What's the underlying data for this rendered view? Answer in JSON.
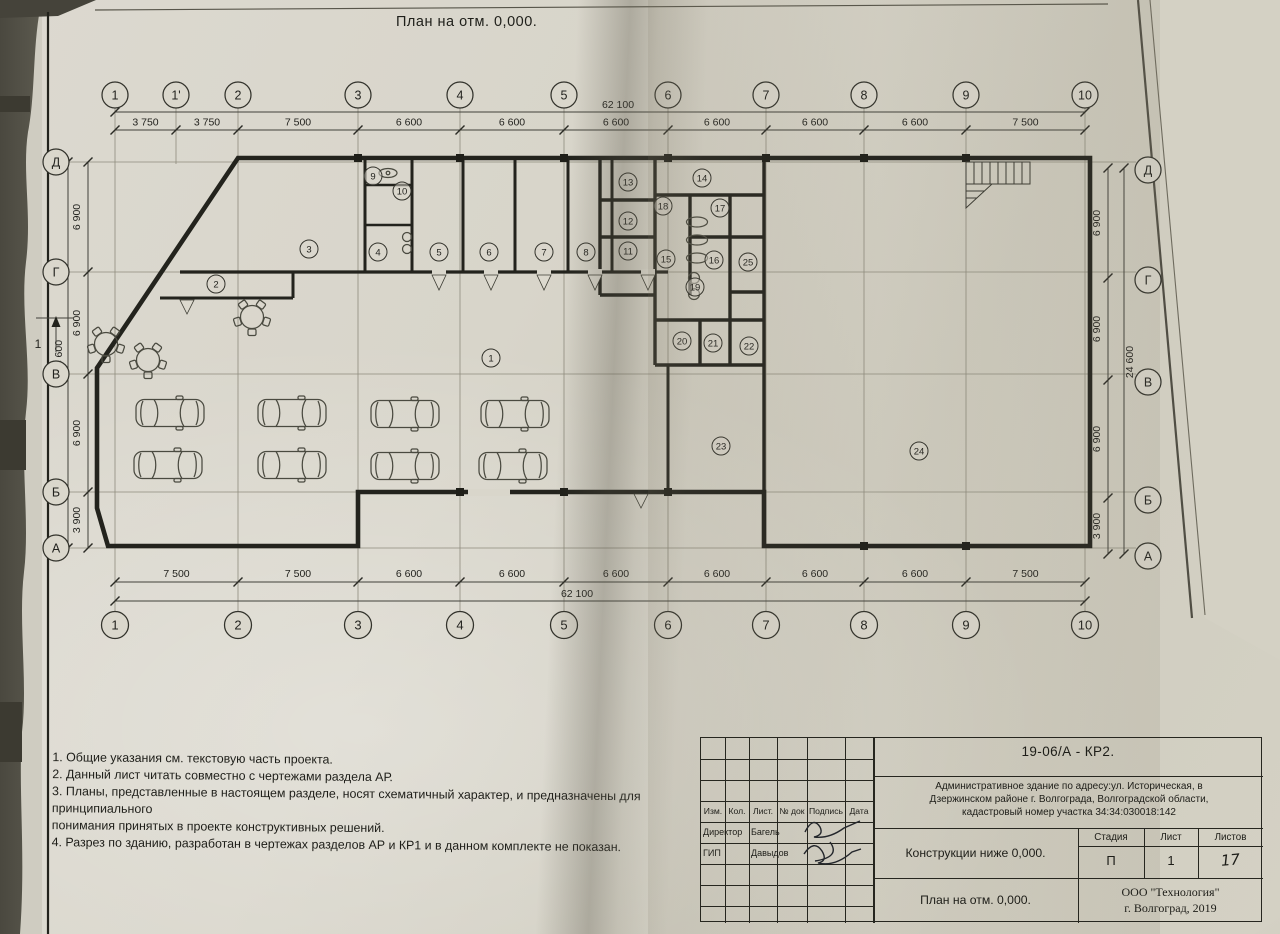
{
  "sheet": {
    "title": "План на отм. 0,000.",
    "section_mark": "1"
  },
  "grid": {
    "top_axes": [
      {
        "label": "1",
        "x": 115
      },
      {
        "label": "1'",
        "x": 176
      },
      {
        "label": "2",
        "x": 238
      },
      {
        "label": "3",
        "x": 358
      },
      {
        "label": "4",
        "x": 460
      },
      {
        "label": "5",
        "x": 564
      },
      {
        "label": "6",
        "x": 668
      },
      {
        "label": "7",
        "x": 766
      },
      {
        "label": "8",
        "x": 864
      },
      {
        "label": "9",
        "x": 966
      },
      {
        "label": "10",
        "x": 1085
      }
    ],
    "bottom_axes": [
      {
        "label": "1",
        "x": 115
      },
      {
        "label": "2",
        "x": 238
      },
      {
        "label": "3",
        "x": 358
      },
      {
        "label": "4",
        "x": 460
      },
      {
        "label": "5",
        "x": 564
      },
      {
        "label": "6",
        "x": 668
      },
      {
        "label": "7",
        "x": 766
      },
      {
        "label": "8",
        "x": 864
      },
      {
        "label": "9",
        "x": 966
      },
      {
        "label": "10",
        "x": 1085
      }
    ],
    "rows": [
      {
        "label": "Д",
        "y": 162
      },
      {
        "label": "Г",
        "y": 272
      },
      {
        "label": "В",
        "y": 374
      },
      {
        "label": "Б",
        "y": 492
      },
      {
        "label": "А",
        "y": 548
      }
    ],
    "top_dims": [
      "3 750",
      "3 750",
      "7 500",
      "6 600",
      "6 600",
      "6 600",
      "6 600",
      "6 600",
      "6 600",
      "7 500"
    ],
    "bottom_dims": [
      "7 500",
      "7 500",
      "6 600",
      "6 600",
      "6 600",
      "6 600",
      "6 600",
      "6 600",
      "7 500"
    ],
    "side_dims": [
      "6 900",
      "6 900",
      "6 900",
      "3 900"
    ],
    "total_width": "62 100",
    "total_height": "24 600"
  },
  "rooms": [
    {
      "n": "1",
      "x": 491,
      "y": 358
    },
    {
      "n": "2",
      "x": 216,
      "y": 284
    },
    {
      "n": "3",
      "x": 309,
      "y": 249
    },
    {
      "n": "4",
      "x": 378,
      "y": 252
    },
    {
      "n": "5",
      "x": 439,
      "y": 252
    },
    {
      "n": "6",
      "x": 489,
      "y": 252
    },
    {
      "n": "7",
      "x": 544,
      "y": 252
    },
    {
      "n": "8",
      "x": 586,
      "y": 252
    },
    {
      "n": "9",
      "x": 373,
      "y": 176
    },
    {
      "n": "10",
      "x": 402,
      "y": 191
    },
    {
      "n": "11",
      "x": 628,
      "y": 251
    },
    {
      "n": "12",
      "x": 628,
      "y": 221
    },
    {
      "n": "13",
      "x": 628,
      "y": 182
    },
    {
      "n": "14",
      "x": 702,
      "y": 178
    },
    {
      "n": "15",
      "x": 666,
      "y": 259
    },
    {
      "n": "16",
      "x": 714,
      "y": 260
    },
    {
      "n": "17",
      "x": 720,
      "y": 208
    },
    {
      "n": "18",
      "x": 663,
      "y": 206
    },
    {
      "n": "19",
      "x": 695,
      "y": 287
    },
    {
      "n": "20",
      "x": 682,
      "y": 341
    },
    {
      "n": "21",
      "x": 713,
      "y": 343
    },
    {
      "n": "22",
      "x": 749,
      "y": 346
    },
    {
      "n": "23",
      "x": 721,
      "y": 446
    },
    {
      "n": "24",
      "x": 919,
      "y": 451
    },
    {
      "n": "25",
      "x": 748,
      "y": 262
    }
  ],
  "notes": [
    "1. Общие указания см. текстовую часть проекта.",
    "2. Данный лист читать совместно с чертежами раздела АР.",
    "3. Планы, представленные в настоящем разделе, носят схематичный характер, и предназначены для принципиального",
    "понимания принятых в проекте конструктивных решений.",
    "4. Разрез по зданию, разработан в чертежах разделов АР и КР1 и в данном комплекте не показан."
  ],
  "title_block": {
    "doc_code": "19-06/А - КР2.",
    "project_line1": "Административное здание по адресу:ул. Историческая, в",
    "project_line2": "Дзержинском районе г. Волгограда, Волгоградской области,",
    "project_line3": "кадастровый номер участка 34:34:030018:142",
    "table_headers": [
      "Изм.",
      "Кол.",
      "Лист.",
      "№ док",
      "Подпись",
      "Дата"
    ],
    "signers": [
      {
        "role": "Директор",
        "name": "Багель"
      },
      {
        "role": "ГИП",
        "name": "Давыдов"
      }
    ],
    "sheet_name_1": "Конструкции ниже 0,000.",
    "sheet_name_2": "План на отм. 0,000.",
    "stage_label": "Стадия",
    "list_label": "Лист",
    "lists_label": "Листов",
    "stage_value": "П",
    "list_value": "1",
    "lists_value": "17",
    "company": "ООО \"Технология\"",
    "place_year": "г. Волгоград, 2019"
  }
}
